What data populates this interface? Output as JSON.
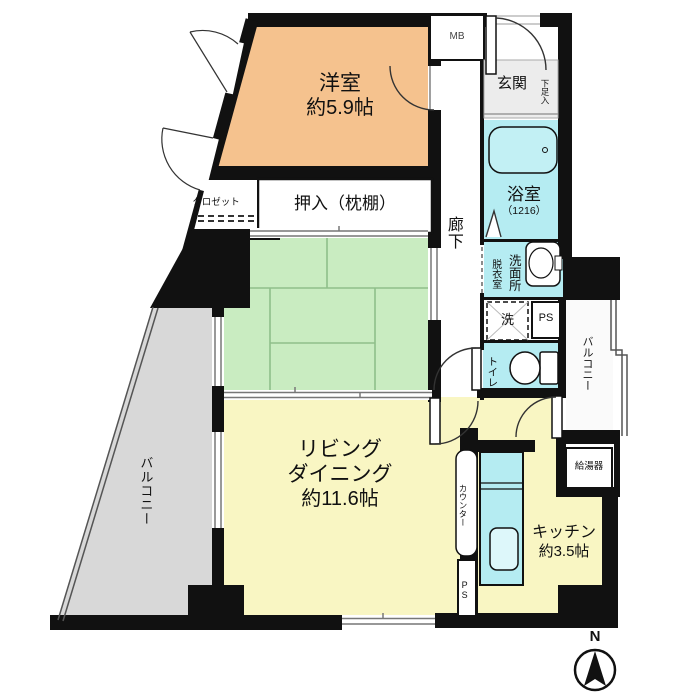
{
  "plan": {
    "rooms": {
      "western_room": {
        "name": "洋室",
        "size": "約5.9帖"
      },
      "japanese_room": {
        "name": "和室",
        "size": "約6.0帖"
      },
      "living_dining": {
        "line1": "リビング",
        "line2": "ダイニング",
        "size": "約11.6帖"
      },
      "kitchen": {
        "name": "キッチン",
        "size": "約3.5帖"
      },
      "bath": {
        "name": "浴室",
        "size": "（1216）"
      },
      "entrance": {
        "name": "玄関"
      },
      "hallway": {
        "name": "廊下"
      },
      "toilet": {
        "name": "トイレ"
      },
      "washroom": {
        "name": "洗面所"
      },
      "dressing_room": {
        "name": "脱衣室"
      },
      "closet": {
        "name": "クロゼット"
      },
      "futon_closet": {
        "name": "押入（枕棚）"
      },
      "balcony_left": {
        "name": "バルコニー"
      },
      "balcony_right": {
        "name": "バルコニー"
      }
    },
    "fixtures": {
      "shoe_box": "下足入",
      "meter_box": "MB",
      "pipe_space_1": "PS",
      "pipe_space_2": "PS",
      "washer": "洗",
      "counter": "カウンター",
      "water_heater": "給湯器"
    },
    "compass": {
      "north": "N"
    },
    "colors": {
      "wall": "#111111",
      "western_room": "#f5c28e",
      "japanese_room": "#c9ecc1",
      "living_kitchen": "#f9f6c3",
      "wet_area": "#b5ecf2",
      "balcony": "#d8d8d8"
    }
  }
}
